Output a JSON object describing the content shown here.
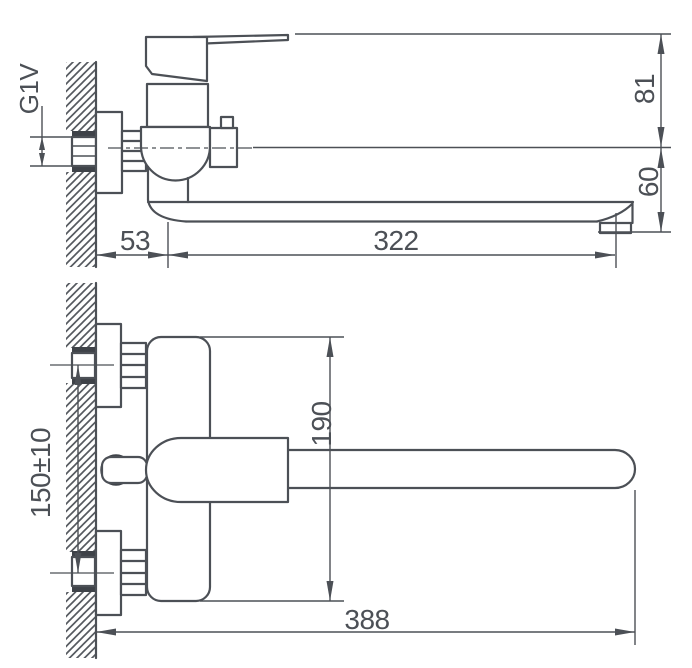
{
  "drawing": {
    "type": "technical-dimension-drawing",
    "views": {
      "side_view_name": "side-projection",
      "front_view_name": "front-projection"
    },
    "labels": {
      "thread": "G1V",
      "wall_offset": "53",
      "spout_reach": "322",
      "upper_height": "81",
      "lower_height": "60",
      "inlet_spacing": "150±10",
      "body_span": "190",
      "total_reach": "388"
    },
    "colors": {
      "line": "#4c5056",
      "dark_accent": "#3e4248",
      "background": "#ffffff"
    }
  }
}
